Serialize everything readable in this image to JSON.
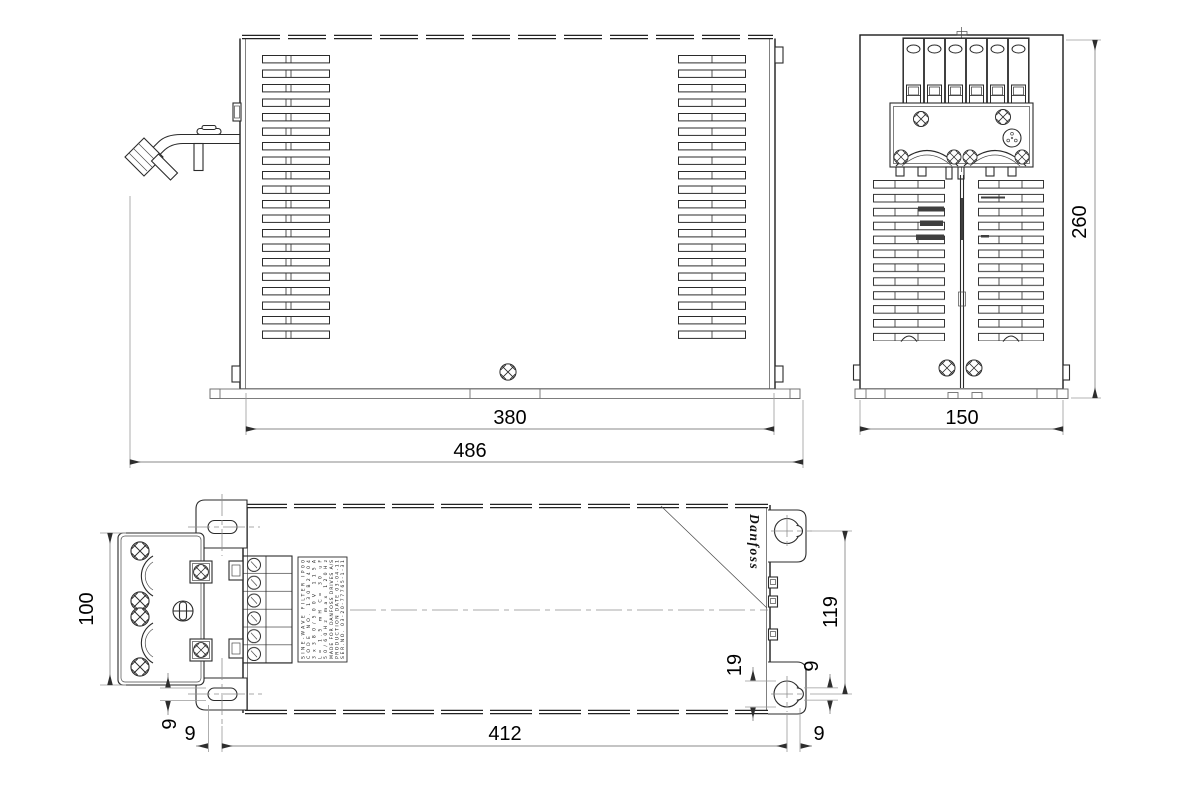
{
  "page": {
    "background": "#ffffff",
    "line_color": "#2b2b2b",
    "dim_line_color": "#8a8a8a",
    "text_color": "#000000"
  },
  "front_view": {
    "dims": {
      "flange_width": "380",
      "overall_width": "486"
    }
  },
  "side_view": {
    "dims": {
      "width": "150",
      "height": "260"
    }
  },
  "top_view": {
    "dims": {
      "depth": "100",
      "slot_width": "9",
      "slot_offset": "9",
      "slot_span": "412",
      "slot_offset_right": "9",
      "keyhole_diameter": "19",
      "keyhole_slot_width": "9",
      "keyhole_center_offset": "119"
    },
    "brand": "Danfoss",
    "nameplate_lines": {
      "0": "SINE-WAVE FILTER IP00",
      "1": "CODE NO. 130B2404",
      "2": "3x380/500V 115A",
      "3": "L= 1.5 mH C= 30 uF",
      "4": "50/60Hz max 120Hz",
      "5": "MADE FOR DANFOSS DRIVES A/S",
      "6": "PRODUCTION DATE 03-04-11",
      "7": "SER.NO. 03-20-77765-1-31"
    }
  }
}
